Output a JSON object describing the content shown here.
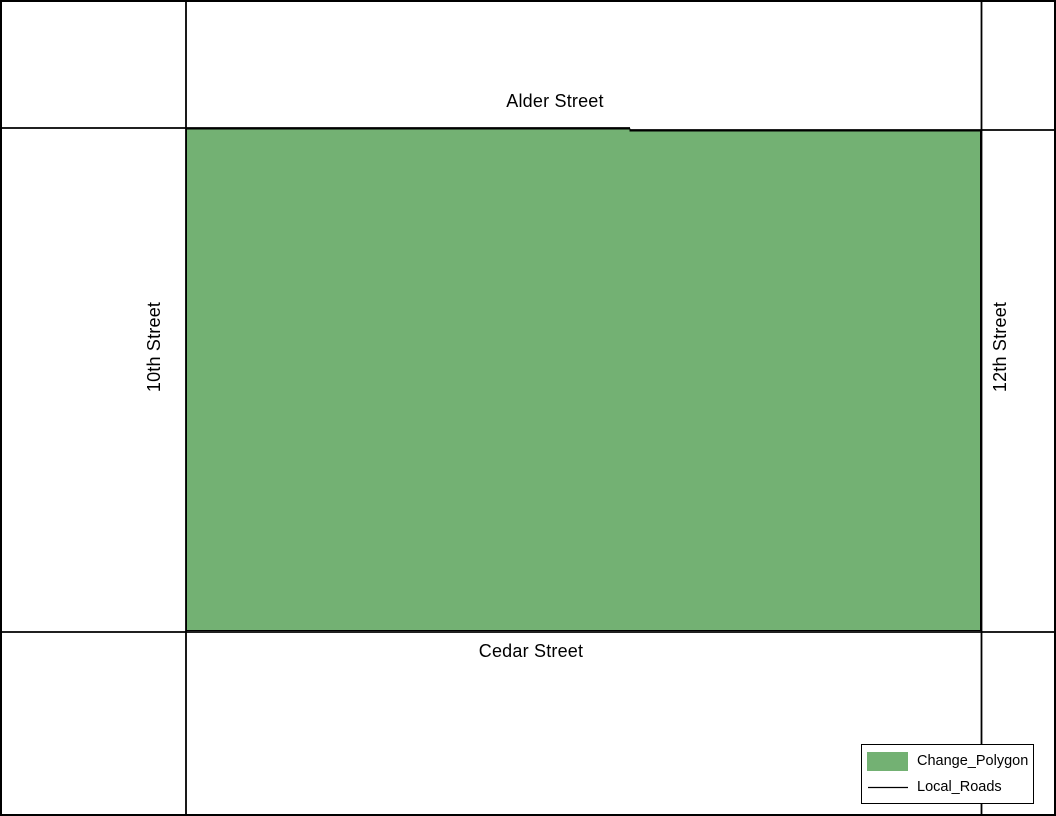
{
  "map": {
    "colors": {
      "background": "#ffffff",
      "frame_border": "#000000",
      "road": "#000000",
      "polygon_fill": "#73b173",
      "polygon_outline": "#000000"
    },
    "street_labels": {
      "top": "Alder Street",
      "bottom": "Cedar Street",
      "left": "10th Street",
      "right": "12th Street"
    }
  },
  "legend": {
    "items": [
      {
        "label": "Change_Polygon",
        "symbol": "polygon-swatch",
        "color": "#73b173"
      },
      {
        "label": "Local_Roads",
        "symbol": "line-swatch",
        "color": "#000000"
      }
    ]
  }
}
